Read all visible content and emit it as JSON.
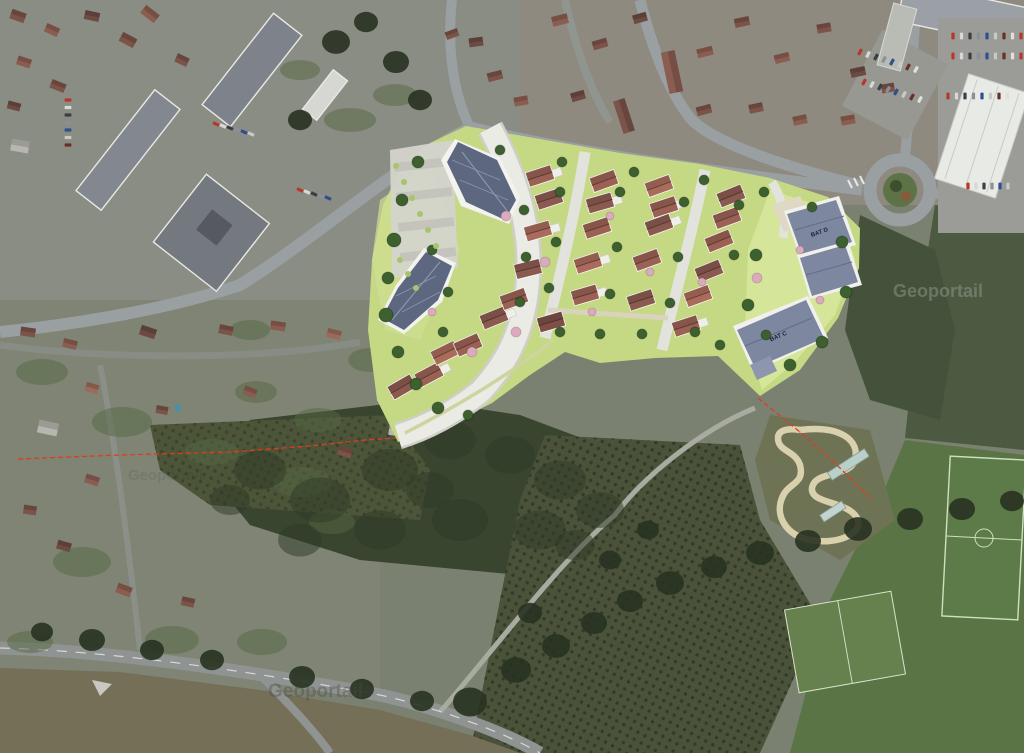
{
  "watermark": {
    "text": "Geoportail"
  },
  "plan": {
    "labels": {
      "bat_c": "BAT C",
      "bat_d": "BAT D"
    },
    "house_palette": [
      "#9a6154",
      "#8a5a50",
      "#a86b5c",
      "#7e4f47"
    ],
    "houses": [
      [
        540,
        176,
        -18,
        0,
        1
      ],
      [
        549,
        199,
        -18,
        1,
        0
      ],
      [
        604,
        181,
        -20,
        0,
        0
      ],
      [
        600,
        203,
        -16,
        1,
        1
      ],
      [
        659,
        186,
        -20,
        2,
        0
      ],
      [
        664,
        207,
        -18,
        0,
        1
      ],
      [
        731,
        196,
        -22,
        1,
        0
      ],
      [
        727,
        218,
        -20,
        0,
        0
      ],
      [
        538,
        231,
        -16,
        2,
        1
      ],
      [
        597,
        228,
        -18,
        0,
        0
      ],
      [
        659,
        225,
        -20,
        1,
        1
      ],
      [
        719,
        241,
        -22,
        0,
        0
      ],
      [
        528,
        269,
        -14,
        1,
        0
      ],
      [
        588,
        263,
        -18,
        2,
        1
      ],
      [
        647,
        260,
        -20,
        0,
        0
      ],
      [
        709,
        271,
        -22,
        1,
        0
      ],
      [
        585,
        295,
        -16,
        0,
        1
      ],
      [
        641,
        300,
        -18,
        1,
        0
      ],
      [
        698,
        296,
        -20,
        2,
        0
      ],
      [
        686,
        326,
        -18,
        0,
        1
      ],
      [
        402,
        387,
        -30,
        1,
        0
      ],
      [
        429,
        375,
        -28,
        0,
        1
      ],
      [
        445,
        353,
        -26,
        2,
        0
      ],
      [
        468,
        345,
        -24,
        0,
        0
      ],
      [
        494,
        318,
        -22,
        1,
        1
      ],
      [
        514,
        299,
        -20,
        0,
        0
      ],
      [
        551,
        322,
        -16,
        3,
        0
      ]
    ],
    "trees_dark": [
      [
        418,
        162,
        6
      ],
      [
        402,
        200,
        6
      ],
      [
        394,
        240,
        7
      ],
      [
        388,
        278,
        6
      ],
      [
        386,
        315,
        7
      ],
      [
        398,
        352,
        6
      ],
      [
        416,
        384,
        6
      ],
      [
        438,
        408,
        6
      ],
      [
        468,
        415,
        5
      ],
      [
        432,
        250,
        5
      ],
      [
        448,
        292,
        5
      ],
      [
        443,
        332,
        5
      ],
      [
        500,
        150,
        5
      ],
      [
        562,
        162,
        5
      ],
      [
        634,
        172,
        5
      ],
      [
        704,
        180,
        5
      ],
      [
        764,
        192,
        5
      ],
      [
        812,
        207,
        5
      ],
      [
        842,
        242,
        6
      ],
      [
        846,
        292,
        6
      ],
      [
        822,
        342,
        6
      ],
      [
        790,
        365,
        6
      ],
      [
        560,
        192,
        5
      ],
      [
        556,
        242,
        5
      ],
      [
        549,
        288,
        5
      ],
      [
        620,
        192,
        5
      ],
      [
        617,
        247,
        5
      ],
      [
        610,
        294,
        5
      ],
      [
        684,
        202,
        5
      ],
      [
        678,
        257,
        5
      ],
      [
        670,
        303,
        5
      ],
      [
        739,
        205,
        5
      ],
      [
        734,
        255,
        5
      ],
      [
        560,
        332,
        5
      ],
      [
        600,
        334,
        5
      ],
      [
        642,
        334,
        5
      ],
      [
        524,
        210,
        5
      ],
      [
        526,
        257,
        5
      ],
      [
        520,
        302,
        5
      ],
      [
        756,
        255,
        6
      ],
      [
        748,
        305,
        6
      ],
      [
        766,
        335,
        5
      ],
      [
        695,
        332,
        5
      ],
      [
        720,
        345,
        5
      ]
    ],
    "trees_pink": [
      [
        506,
        216,
        5
      ],
      [
        545,
        262,
        5
      ],
      [
        516,
        332,
        5
      ],
      [
        472,
        352,
        5
      ],
      [
        610,
        216,
        4
      ],
      [
        650,
        272,
        4
      ],
      [
        702,
        282,
        4
      ],
      [
        592,
        312,
        4
      ],
      [
        757,
        278,
        5
      ],
      [
        432,
        312,
        4
      ],
      [
        800,
        250,
        4
      ],
      [
        820,
        300,
        4
      ]
    ],
    "shrubs": [
      [
        396,
        166,
        3
      ],
      [
        404,
        182,
        3
      ],
      [
        412,
        198,
        3
      ],
      [
        420,
        214,
        3
      ],
      [
        428,
        230,
        3
      ],
      [
        436,
        246,
        3
      ],
      [
        400,
        260,
        3
      ],
      [
        408,
        274,
        3
      ],
      [
        416,
        288,
        3
      ]
    ]
  },
  "photo": {
    "house_palette": [
      "#7c5348",
      "#8b5c50",
      "#6d4a42",
      "#9b6a58",
      "#b7b7af",
      "#a33d32"
    ],
    "houses": [
      [
        18,
        16,
        20,
        15,
        10,
        0
      ],
      [
        52,
        30,
        24,
        14,
        9,
        1
      ],
      [
        92,
        16,
        12,
        15,
        9,
        2
      ],
      [
        128,
        40,
        28,
        16,
        10,
        0
      ],
      [
        24,
        62,
        18,
        14,
        9,
        1
      ],
      [
        58,
        86,
        22,
        15,
        9,
        0
      ],
      [
        14,
        106,
        14,
        13,
        8,
        2
      ],
      [
        150,
        14,
        38,
        17,
        10,
        1
      ],
      [
        182,
        60,
        25,
        13,
        9,
        0
      ],
      [
        20,
        146,
        10,
        18,
        12,
        4
      ],
      [
        495,
        76,
        -14,
        15,
        9,
        0
      ],
      [
        521,
        101,
        -10,
        14,
        9,
        1
      ],
      [
        476,
        42,
        -8,
        14,
        9,
        2
      ],
      [
        452,
        34,
        -20,
        13,
        8,
        0
      ],
      [
        560,
        20,
        -14,
        16,
        10,
        1
      ],
      [
        600,
        44,
        -16,
        15,
        9,
        0
      ],
      [
        640,
        18,
        -16,
        14,
        9,
        2
      ],
      [
        672,
        72,
        78,
        42,
        14,
        1
      ],
      [
        624,
        116,
        72,
        34,
        12,
        0
      ],
      [
        705,
        52,
        -14,
        16,
        9,
        1
      ],
      [
        742,
        22,
        -12,
        15,
        9,
        0
      ],
      [
        782,
        58,
        -14,
        15,
        9,
        1
      ],
      [
        824,
        28,
        -10,
        14,
        9,
        0
      ],
      [
        858,
        72,
        -12,
        15,
        9,
        2
      ],
      [
        756,
        108,
        -12,
        14,
        9,
        0
      ],
      [
        800,
        120,
        -12,
        14,
        9,
        1
      ],
      [
        578,
        96,
        -16,
        14,
        9,
        2
      ],
      [
        704,
        110,
        -15,
        15,
        9,
        0
      ],
      [
        848,
        120,
        -10,
        14,
        9,
        1
      ],
      [
        888,
        88,
        -10,
        13,
        9,
        0
      ],
      [
        28,
        332,
        8,
        15,
        9,
        0
      ],
      [
        70,
        344,
        14,
        14,
        9,
        1
      ],
      [
        148,
        332,
        18,
        16,
        10,
        2
      ],
      [
        226,
        330,
        12,
        14,
        9,
        0
      ],
      [
        278,
        326,
        8,
        15,
        9,
        1
      ],
      [
        334,
        334,
        14,
        14,
        9,
        3
      ],
      [
        48,
        428,
        12,
        20,
        13,
        4
      ],
      [
        92,
        480,
        18,
        14,
        9,
        1
      ],
      [
        30,
        510,
        8,
        13,
        9,
        0
      ],
      [
        64,
        546,
        16,
        14,
        9,
        2
      ],
      [
        124,
        590,
        20,
        15,
        10,
        1
      ],
      [
        188,
        602,
        12,
        13,
        9,
        0
      ],
      [
        92,
        388,
        16,
        13,
        9,
        3
      ],
      [
        345,
        452,
        18,
        14,
        9,
        0
      ],
      [
        398,
        430,
        8,
        18,
        12,
        4
      ],
      [
        250,
        392,
        20,
        13,
        9,
        1
      ],
      [
        162,
        410,
        10,
        12,
        8,
        0
      ]
    ],
    "car_palette": [
      "#b8372b",
      "#d8d8d4",
      "#3a3f45",
      "#8a9098",
      "#2f4f8f",
      "#c9c9c4",
      "#6b2f2a",
      "#dfe0da"
    ],
    "car_rows": [
      {
        "x": 953,
        "y": 36,
        "dx": 8.5,
        "dy": 0,
        "count": 9,
        "rot": 0
      },
      {
        "x": 953,
        "y": 56,
        "dx": 8.5,
        "dy": 0,
        "count": 9,
        "rot": 0
      },
      {
        "x": 948,
        "y": 96,
        "dx": 8.5,
        "dy": 0,
        "count": 8,
        "rot": 0
      },
      {
        "x": 860,
        "y": 52,
        "dx": 8,
        "dy": 2.5,
        "count": 8,
        "rot": 28
      },
      {
        "x": 864,
        "y": 82,
        "dx": 8,
        "dy": 2.5,
        "count": 8,
        "rot": 28
      },
      {
        "x": 68,
        "y": 100,
        "dx": 0,
        "dy": 7.5,
        "count": 7,
        "rot": 90
      },
      {
        "x": 216,
        "y": 124,
        "dx": 7,
        "dy": 2,
        "count": 6,
        "rot": 115
      },
      {
        "x": 300,
        "y": 190,
        "dx": 7,
        "dy": 2,
        "count": 5,
        "rot": 115
      },
      {
        "x": 968,
        "y": 186,
        "dx": 8,
        "dy": 0,
        "count": 6,
        "rot": 0
      }
    ],
    "garden_blobs": [
      [
        42,
        372,
        26,
        13
      ],
      [
        122,
        422,
        30,
        15
      ],
      [
        212,
        452,
        27,
        13
      ],
      [
        302,
        482,
        29,
        15
      ],
      [
        82,
        562,
        29,
        15
      ],
      [
        172,
        640,
        27,
        14
      ],
      [
        262,
        642,
        25,
        13
      ],
      [
        256,
        392,
        21,
        11
      ],
      [
        332,
        522,
        23,
        12
      ],
      [
        30,
        642,
        23,
        11
      ],
      [
        350,
        120,
        26,
        12
      ],
      [
        395,
        95,
        22,
        11
      ],
      [
        300,
        70,
        20,
        10
      ],
      [
        250,
        330,
        20,
        10
      ],
      [
        370,
        360,
        22,
        12
      ],
      [
        318,
        420,
        24,
        12
      ]
    ],
    "forest_blobs": [
      [
        260,
        470,
        26
      ],
      [
        320,
        500,
        30
      ],
      [
        390,
        470,
        28
      ],
      [
        450,
        440,
        26
      ],
      [
        510,
        455,
        25
      ],
      [
        560,
        480,
        26
      ],
      [
        600,
        510,
        24
      ],
      [
        540,
        530,
        26
      ],
      [
        460,
        520,
        28
      ],
      [
        380,
        530,
        26
      ],
      [
        300,
        540,
        22
      ],
      [
        230,
        500,
        20
      ],
      [
        430,
        490,
        24
      ],
      [
        575,
        545,
        20
      ]
    ],
    "treeline_blobs": [
      [
        470,
        702,
        17
      ],
      [
        516,
        670,
        15
      ],
      [
        556,
        646,
        14
      ],
      [
        594,
        623,
        13
      ],
      [
        630,
        601,
        13
      ],
      [
        670,
        583,
        14
      ],
      [
        714,
        567,
        13
      ],
      [
        760,
        553,
        14
      ],
      [
        808,
        541,
        13
      ],
      [
        858,
        529,
        14
      ],
      [
        910,
        519,
        13
      ],
      [
        962,
        509,
        13
      ],
      [
        1012,
        501,
        12
      ],
      [
        92,
        640,
        13
      ],
      [
        152,
        650,
        12
      ],
      [
        42,
        632,
        11
      ],
      [
        212,
        660,
        12
      ],
      [
        302,
        677,
        13
      ],
      [
        362,
        689,
        12
      ],
      [
        422,
        701,
        12
      ],
      [
        530,
        613,
        12
      ],
      [
        610,
        560,
        11
      ],
      [
        648,
        530,
        11
      ],
      [
        336,
        42,
        14
      ],
      [
        366,
        22,
        12
      ],
      [
        396,
        62,
        13
      ],
      [
        420,
        100,
        12
      ],
      [
        300,
        120,
        12
      ]
    ]
  },
  "colors": {
    "overlay_green": "#c5d884",
    "overlay_green_light": "#d6e79b",
    "plan_road": "#ebebe5",
    "apartment_roof": "#5d6880",
    "bat_roof": "#7d87a0",
    "boundary_red": "#e03b20",
    "forest": "#39452e",
    "orchard": "#4a523a",
    "field": "#756f58",
    "pitch": "#5d7a49",
    "sand_track": "#d9d0ad",
    "asphalt": "#9aa0a2"
  }
}
